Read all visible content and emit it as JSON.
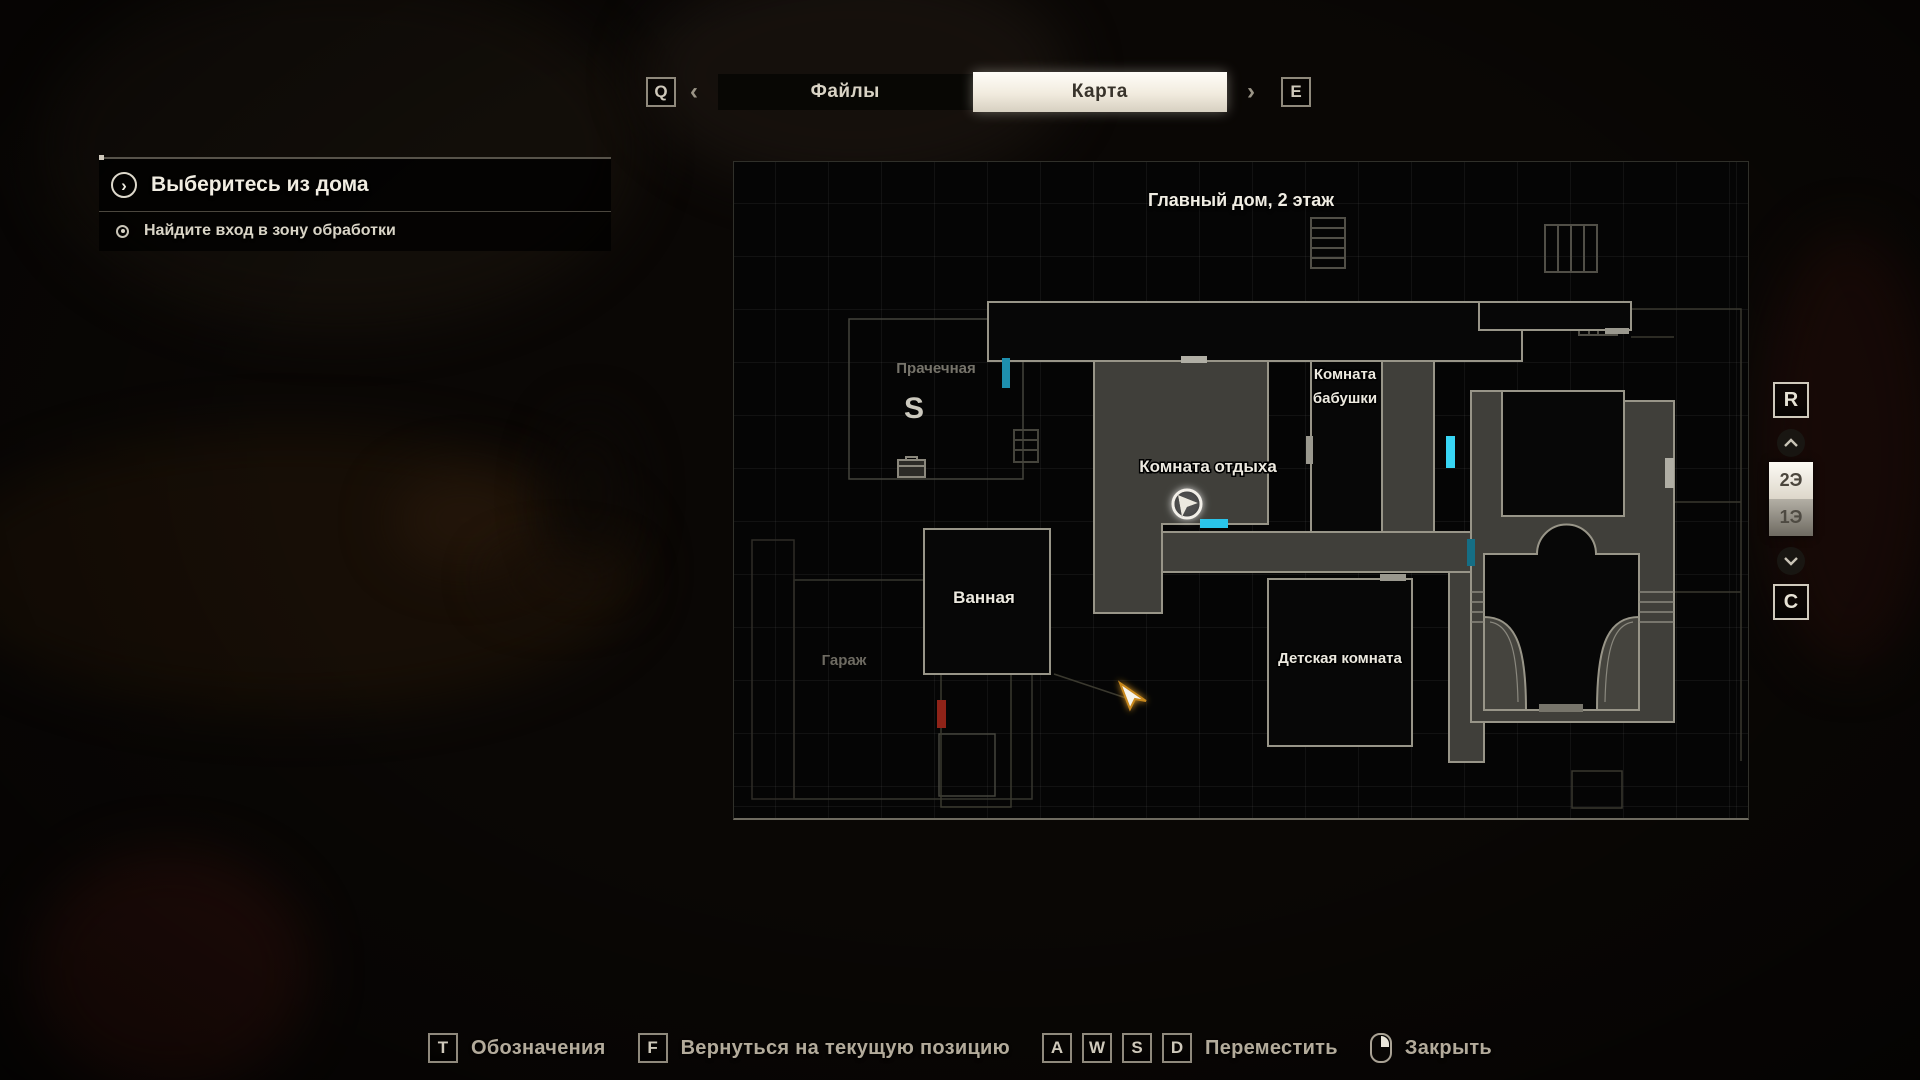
{
  "tab_bar": {
    "key_prev": "Q",
    "key_next": "E",
    "arrow_prev": "‹",
    "arrow_next": "›",
    "tabs": [
      {
        "label": "Файлы",
        "active": false
      },
      {
        "label": "Карта",
        "active": true
      }
    ]
  },
  "objectives": {
    "main": "Выберитесь из дома",
    "main_icon_glyph": "›",
    "secondary": "Найдите вход в зону обработки"
  },
  "map": {
    "title": "Главный дом, 2 этаж",
    "rooms": {
      "laundry": "Прачечная",
      "grandma_line1": "Комната",
      "grandma_line2": "бабушки",
      "recreation": "Комната отдыха",
      "bathroom": "Ванная",
      "garage": "Гараж",
      "kids": "Детская комната"
    },
    "save_icon_label": "S"
  },
  "floor_selector": {
    "key_up": "R",
    "key_down": "C",
    "floors": [
      {
        "label": "2Э",
        "active": true
      },
      {
        "label": "1Э",
        "active": false
      }
    ]
  },
  "footer": {
    "hints": [
      {
        "key": "T",
        "label": "Обозначения"
      },
      {
        "key": "F",
        "label": "Вернуться на текущую позицию"
      },
      {
        "keys": [
          "A",
          "W",
          "S",
          "D"
        ],
        "label": "Переместить"
      },
      {
        "label": "Закрыть"
      }
    ]
  },
  "colors": {
    "door_cyan_bright": "#38d6f5",
    "door_cyan": "#2ac4ea",
    "door_teal_dim": "#1e8fae",
    "door_red": "#8f2318",
    "marker_gray": "#a8a69c",
    "active_tab_bg": "#f1ebde",
    "wall_gray": "#989588",
    "explored_fill": "#403f3a"
  }
}
